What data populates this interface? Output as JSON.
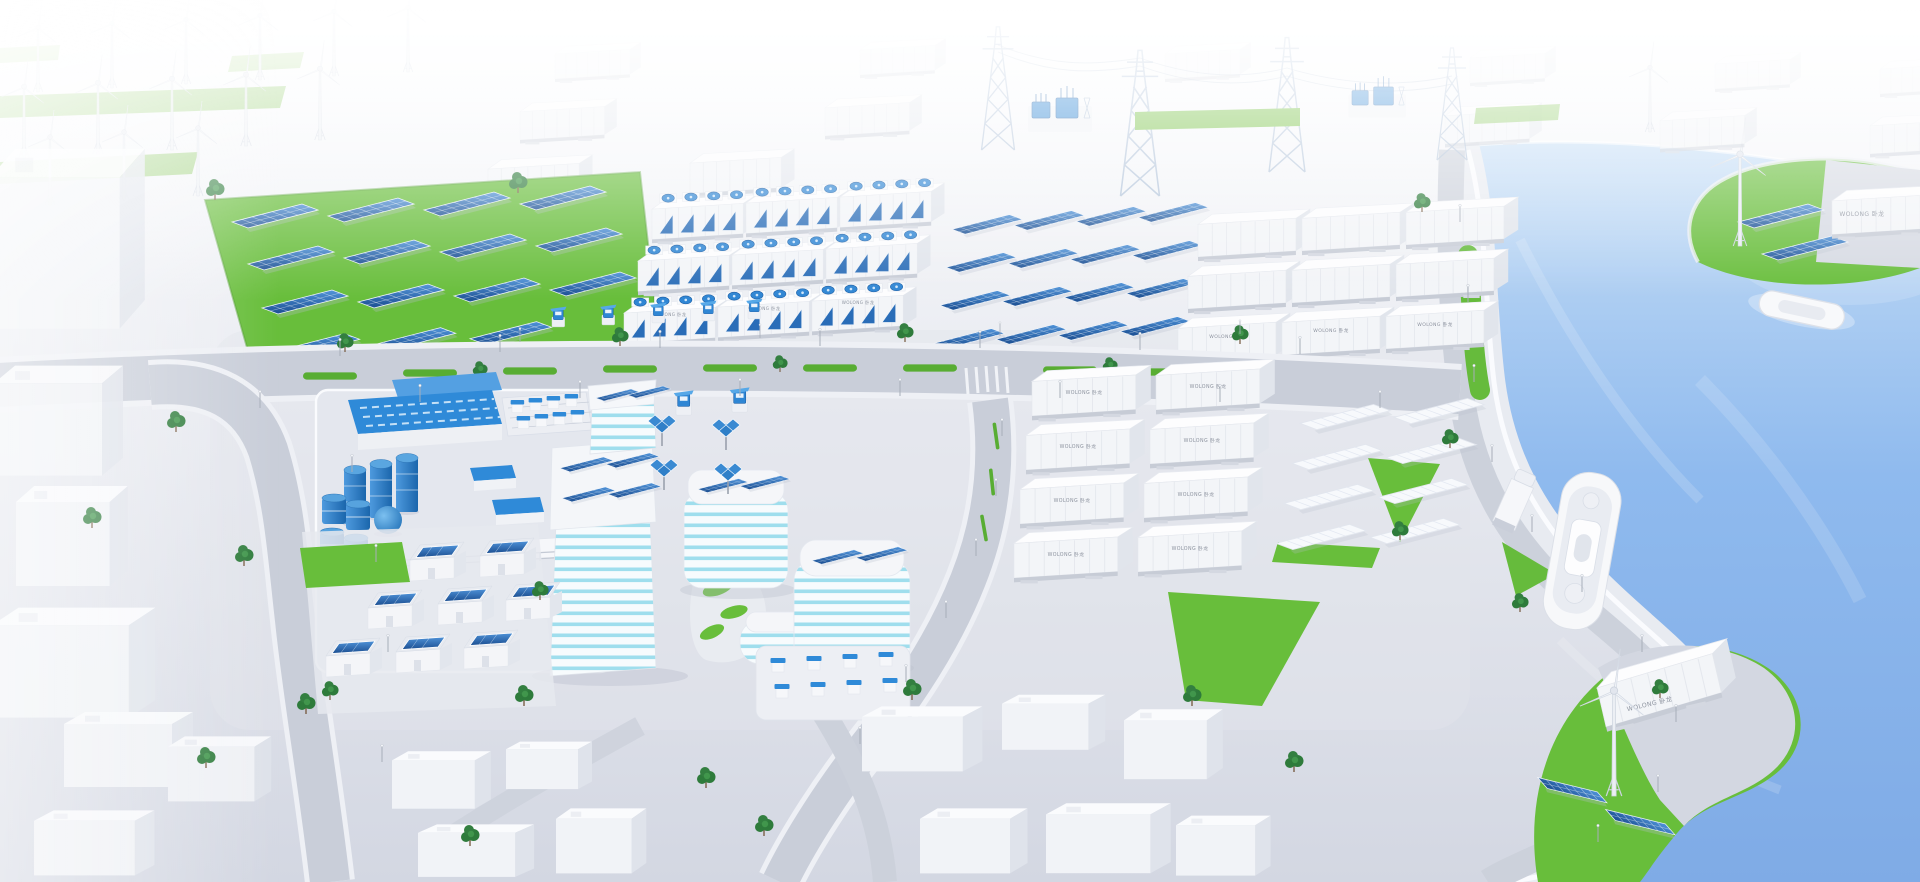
{
  "image": {
    "kind": "3d-aerial-isometric-render",
    "subject": "Coastal smart-energy city: wind farm, solar farm, battery container yards, substation, industrial plant, smart campus with rooftop PV, harbor with ferry and green energy islands"
  },
  "brand": {
    "container_label": "WOLONG 卧龙"
  },
  "palette": {
    "background_top": "#fcfdfe",
    "ground": "#d5d9e3",
    "plaza": "#e4e7ee",
    "road": "#c9ced9",
    "sidewalk": "#eef0f5",
    "curb_white": "#fafbfd",
    "water": "#8ab6ec",
    "water_far": "#c6def6",
    "grass": "#68be3b",
    "grass_dark": "#4f9e2e",
    "pv_blue": "#2c6ab1",
    "pv_blue_dark": "#1c4f92",
    "equipment_blue": "#2f86d4",
    "teal_stripe": "#9fdeed",
    "structure_white": "#f4f5f8",
    "structure_shade": "#e1e5ec",
    "steel_lattice": "#a9bdd6",
    "tree_green": "#2e7b3b",
    "shadow": "#b9bfcc"
  },
  "scene": {
    "areas": [
      {
        "id": "wind-farm",
        "description": "rows of white wind turbines on green strips, top left"
      },
      {
        "id": "container-rows-far",
        "description": "white storage containers fading into fog, top band"
      },
      {
        "id": "transmission",
        "description": "lattice pylons with power lines and two blue substations"
      },
      {
        "id": "solar-farm",
        "description": "blue PV arrays on bright green field"
      },
      {
        "id": "battery-storage",
        "description": "3x3 container units with blue cooling fans"
      },
      {
        "id": "pv-yard",
        "description": "4x4 blue PV tables on paved yard"
      },
      {
        "id": "container-block",
        "description": "3x3 labelled white containers, upper right"
      },
      {
        "id": "container-yard",
        "description": "2x4 labelled white containers, mid right"
      },
      {
        "id": "panel-racks",
        "description": "white rack rows beside green triangles"
      },
      {
        "id": "industrial-plant",
        "description": "fenced plant with blue roofs, cylinder tanks, barrel stacks, sphere tank"
      },
      {
        "id": "campus",
        "description": "teal-striped tower and curved buildings with rooftop PV, solar trees, EV chargers, kiosk parking"
      },
      {
        "id": "residential",
        "description": "small houses with rooftop PV"
      },
      {
        "id": "city-blocks",
        "description": "plain white low-poly city buildings"
      },
      {
        "id": "harbor",
        "description": "blue river with ferry, small boat, quay promenade, truck"
      },
      {
        "id": "islands",
        "description": "two green islands, each with wind turbine, PV panels and a labelled container"
      }
    ],
    "counts": {
      "wind_turbines": 17,
      "battery_fan_units": 9,
      "solar_field_arrays": 15,
      "solar_yard_arrays": 16,
      "labeled_containers": 19,
      "white_panel_racks": 8,
      "pv_houses": 8,
      "parking_kiosks": 8,
      "solar_trees": 4,
      "ev_chargers": 7,
      "storage_tanks": 8,
      "boats": 2,
      "trucks": 1,
      "substations": 2,
      "pylons": 4
    }
  }
}
